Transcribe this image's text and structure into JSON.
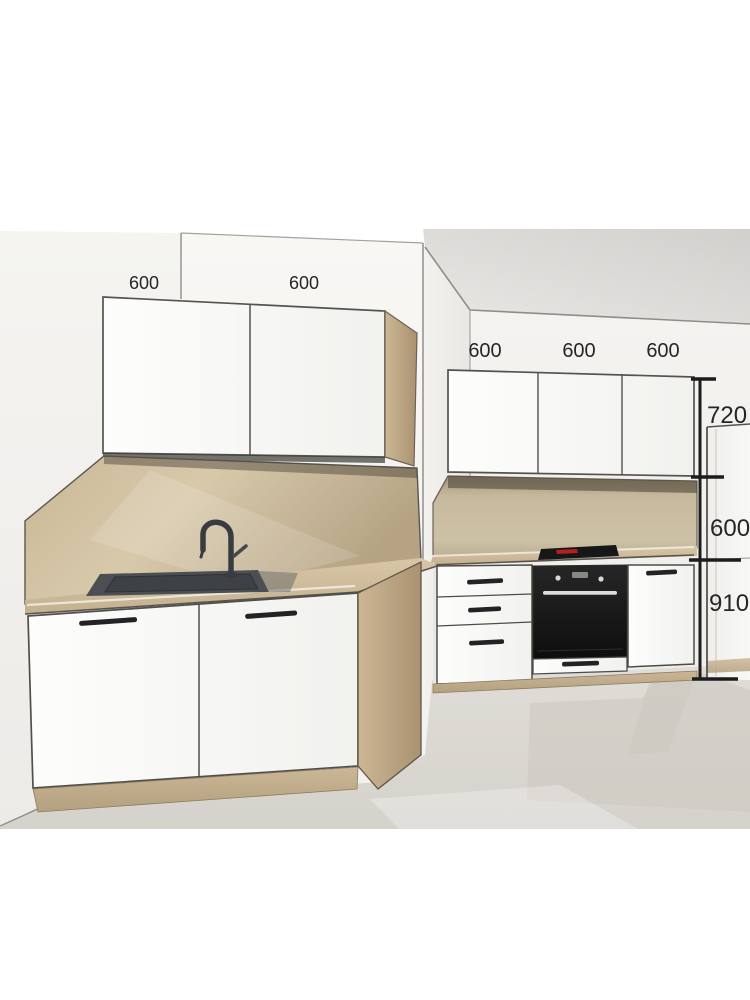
{
  "scene": {
    "description": "3D kitchen planner preview render with dimension annotations",
    "units": "mm"
  },
  "dimensions": {
    "left_wall_cabinets": [
      {
        "label": "600"
      },
      {
        "label": "600"
      }
    ],
    "back_wall_cabinets": [
      {
        "label": "600"
      },
      {
        "label": "600"
      },
      {
        "label": "600"
      }
    ],
    "height_chain": {
      "wall_cabinet_height": "720",
      "backsplash_gap": "600",
      "base_height_with_plinth": "910"
    }
  },
  "palette": {
    "background": "#ffffff",
    "wall_light": "#f5f4f1",
    "wall_back": "#f1f0ed",
    "ceiling_shadow": "#d4d2cf",
    "wood_light": "#d3c2a2",
    "wood_dark": "#b29c7a",
    "cabinet_white": "#fafaf9",
    "outline": "#4e4c48",
    "floor": "#dcd9d4",
    "floor_shadow": "#cdc9c2",
    "appliance_black": "#161616",
    "cooktop_accent_red": "#b5201d",
    "sink_gray": "#4b4f53",
    "dimension_ink": "#1c1c1c"
  }
}
